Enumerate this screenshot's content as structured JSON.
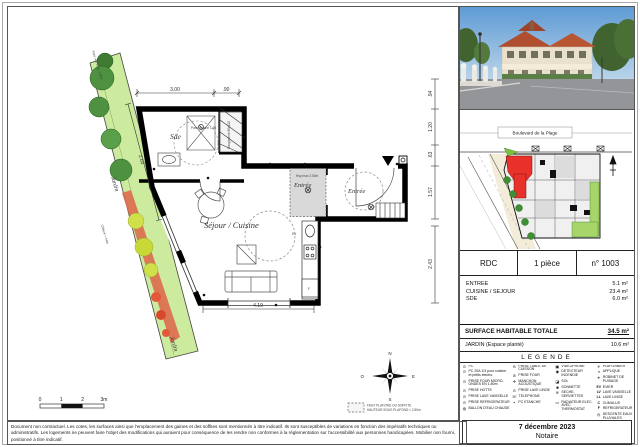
{
  "page": {
    "disclaimer": "Document non contractuel. Les cotes, les surfaces ainsi que l'emplacement des gaines et des soffites sont mentionnés à titre indicatif. Ils sont susceptibles de variations en fonction des impératifs techniques ou administratifs. Les logements ne peuvent faire l'objet des modifications qui auraient pour conséquence de les rendre non conformes à la réglementation sur l'accessibilité aux personnes handicapées. Mobilier non fourni, positionné à titre indicatif.",
    "date": "7 décembre 2023",
    "doc_type": "Notaire"
  },
  "plan": {
    "room_sde": "Sde",
    "room_sejour": "Séjour / Cuisine",
    "room_entree_int": "Entrée",
    "room_entree_ext": "Entrée",
    "label_ev": "EV",
    "label_f": "F",
    "label_jardin_1": "Jardin",
    "label_jardin_2": "Jardin",
    "note_hsp": "Hsp max 2.50m",
    "note_rangement": "Rangement 60x120",
    "note_pare_douche": "Pare douche 1.60",
    "note_pare_vue": "Pare vue haut. 1.80m",
    "note_cloture": "Clôture + haie",
    "dim_top_1": "3.00",
    "dim_top_2": ".90",
    "dim_right_1": ".94",
    "dim_right_2": "1.20",
    "dim_right_3": ".63",
    "dim_right_4": "1.57",
    "dim_right_5": "2.43",
    "dim_bottom": "4.19",
    "dim_garden": "2.03",
    "scale_0": "0",
    "scale_1": "1",
    "scale_2": "2",
    "scale_3": "3m",
    "compass_n": "N",
    "compass_s": "S",
    "compass_e": "E",
    "compass_o": "O",
    "ceiling_note_1": "FAUX PLAFOND OU SOFFITE",
    "ceiling_note_2": "HAUTEUR SOUS PLAFOND < 2.50m"
  },
  "panel": {
    "street_label": "Boulevard de la Plage",
    "unit_level": "RDC",
    "unit_type": "1 pièce",
    "unit_number": "n° 1003",
    "surfaces": [
      {
        "label": "ENTREE",
        "value": "5.1 m²"
      },
      {
        "label": "CUISINE / SEJOUR",
        "value": "23.4 m²"
      },
      {
        "label": "SDE",
        "value": "6.0 m²"
      }
    ],
    "total_label": "SURFACE HABITABLE TOTALE",
    "total_value": "34.5 m²",
    "garden_label": "JARDIN (Espace planté)",
    "garden_value": "10.6 m²",
    "legend_title": "LEGENDE",
    "legend_items": [
      {
        "icon": "⊙",
        "label": "PC"
      },
      {
        "icon": "⊙",
        "label": "PC 20A 1/3 pour cuisine et petits électro."
      },
      {
        "icon": "⊙",
        "label": "PRISE FOUR MICRO-ONDES EN 1.80m"
      },
      {
        "icon": "⊙",
        "label": "PRISE HOTTE"
      },
      {
        "icon": "⊙",
        "label": "PRISE LAVE VAISSELLE"
      },
      {
        "icon": "⊙",
        "label": "PRISE REFRIGERATEUR"
      },
      {
        "icon": "◍",
        "label": "BALLON D'EAU CHAUDE"
      },
      {
        "icon": "⊖",
        "label": "PRISE TABLE DE CUISSON"
      },
      {
        "icon": "⊘",
        "label": "PRISE FOUR"
      },
      {
        "icon": "✛",
        "label": "MANCHON ACOUSTIQUE"
      },
      {
        "icon": "⊙",
        "label": "PRISE LAVE LINGE"
      },
      {
        "icon": "☏",
        "label": "TELEPHONE"
      },
      {
        "icon": "▪",
        "label": "PC ETANCHE"
      },
      {
        "icon": "▣",
        "label": "VIDEOPHONE"
      },
      {
        "icon": "◉",
        "label": "DETECTEUR INCENDIE"
      },
      {
        "icon": "◪",
        "label": "SOL"
      },
      {
        "icon": "■",
        "label": "SONNETTE"
      },
      {
        "icon": "≋",
        "label": "SECHE-SERVIETTES"
      },
      {
        "icon": "▭",
        "label": "RADIATEUR ELEC. AVEC THERMOSTAT"
      },
      {
        "icon": "✳",
        "label": "PLAFONNIER"
      },
      {
        "icon": "◑",
        "label": "APPLIQUE"
      },
      {
        "icon": "⌖",
        "label": "ROBINET DE PUISAGE"
      },
      {
        "icon": "EV",
        "label": "EVIER"
      },
      {
        "icon": "LV",
        "label": "LAVE VAISSELLE"
      },
      {
        "icon": "LL",
        "label": "LAVE LINGE"
      },
      {
        "icon": "C",
        "label": "CUMULUS"
      },
      {
        "icon": "F",
        "label": "REFRIGERATEUR"
      },
      {
        "icon": "◎",
        "label": "DESCENTE EAUX PLUVIALES"
      }
    ]
  },
  "colors": {
    "unit_red": "#e8312a",
    "garden_green": "#cdeb9e",
    "tree_green": "#4e9140",
    "planting_red": "#dd6b4d",
    "wall_black": "#000000"
  }
}
